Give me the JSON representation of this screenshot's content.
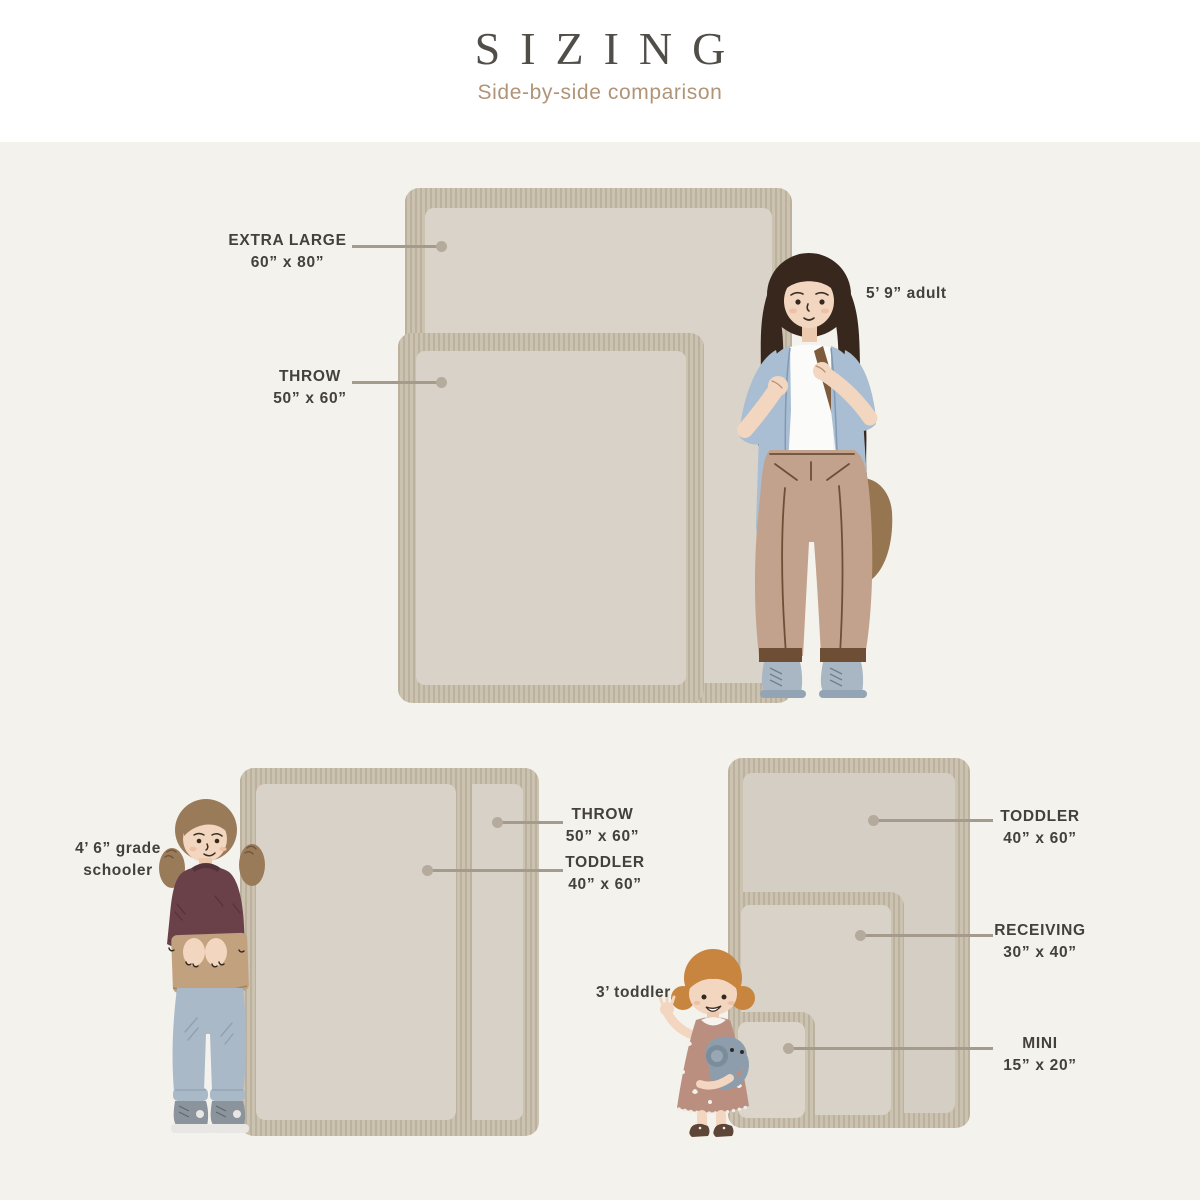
{
  "title": "SIZING",
  "subtitle": "Side-by-side comparison",
  "colors": {
    "background": "#f4f2ed",
    "header_background": "#ffffff",
    "title_text": "#514e49",
    "subtitle_text": "#b19478",
    "label_text": "#44403b",
    "leader_line": "#a49b8d",
    "blanket_fringe": "#ccc2b0",
    "blanket_face": "#d8d2c8"
  },
  "groups": {
    "adult": {
      "person": "5’ 9” adult",
      "callouts": [
        {
          "name": "EXTRA LARGE",
          "size": "60” x 80”",
          "width_in": 60,
          "height_in": 80
        },
        {
          "name": "THROW",
          "size": "50” x 60”",
          "width_in": 50,
          "height_in": 60
        }
      ]
    },
    "grade_schooler": {
      "person": "4’ 6” grade schooler",
      "callouts": [
        {
          "name": "THROW",
          "size": "50” x 60”",
          "width_in": 50,
          "height_in": 60
        },
        {
          "name": "TODDLER",
          "size": "40” x 60”",
          "width_in": 40,
          "height_in": 60
        }
      ]
    },
    "toddler": {
      "person": "3’ toddler",
      "callouts": [
        {
          "name": "TODDLER",
          "size": "40” x 60”",
          "width_in": 40,
          "height_in": 60
        },
        {
          "name": "RECEIVING",
          "size": "30” x 40”",
          "width_in": 30,
          "height_in": 40
        },
        {
          "name": "MINI",
          "size": "15” x 20”",
          "width_in": 15,
          "height_in": 20
        }
      ]
    }
  }
}
